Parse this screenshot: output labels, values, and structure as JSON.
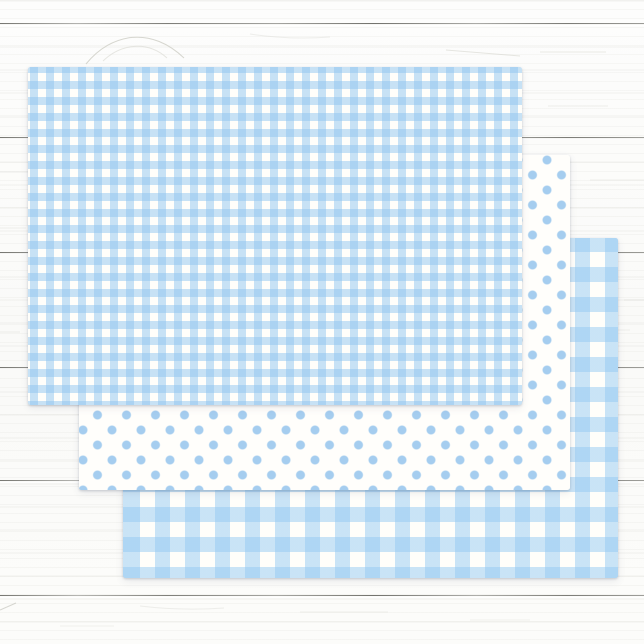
{
  "scene": {
    "description": "Three overlapping sheets of pastel blue patterned wrapping tissue paper fanned out diagonally on a white shiplap wood plank surface",
    "aria_label": "Product photo: blue gingham and polka dot wrapping paper sheets on white wood"
  },
  "background": {
    "type": "white-painted-wood-planks",
    "base_color": "#fbfbf9",
    "plank_line_color": "#60605a",
    "plank_line_ys": [
      23,
      137,
      252,
      367,
      480,
      595
    ]
  },
  "sheets": [
    {
      "name": "gingham-small",
      "pattern": "gingham",
      "description": "Small blue-and-white gingham check paper (top sheet)",
      "check_size_px": 8,
      "stripe_color": "rgba(143,196,239,0.50)",
      "paper_color": "#fffefa",
      "x": 28,
      "y": 67,
      "width": 494,
      "height": 338,
      "z": 3
    },
    {
      "name": "polka-dots",
      "pattern": "polka-dot",
      "description": "Blue polka dots on white paper (middle sheet)",
      "dot_diameter_px": 9,
      "dot_tile_w_px": 29,
      "dot_tile_h_px": 30,
      "dot_color": "#a5cdef",
      "paper_color": "#fffefb",
      "x": 79,
      "y": 155,
      "width": 491,
      "height": 335,
      "z": 2
    },
    {
      "name": "gingham-large",
      "pattern": "gingham",
      "description": "Large blue-and-white gingham check paper (bottom sheet)",
      "check_size_px": 15,
      "stripe_color": "rgba(148,200,241,0.50)",
      "paper_color": "#fffefa",
      "x": 123,
      "y": 238,
      "width": 495,
      "height": 340,
      "z": 1
    }
  ]
}
